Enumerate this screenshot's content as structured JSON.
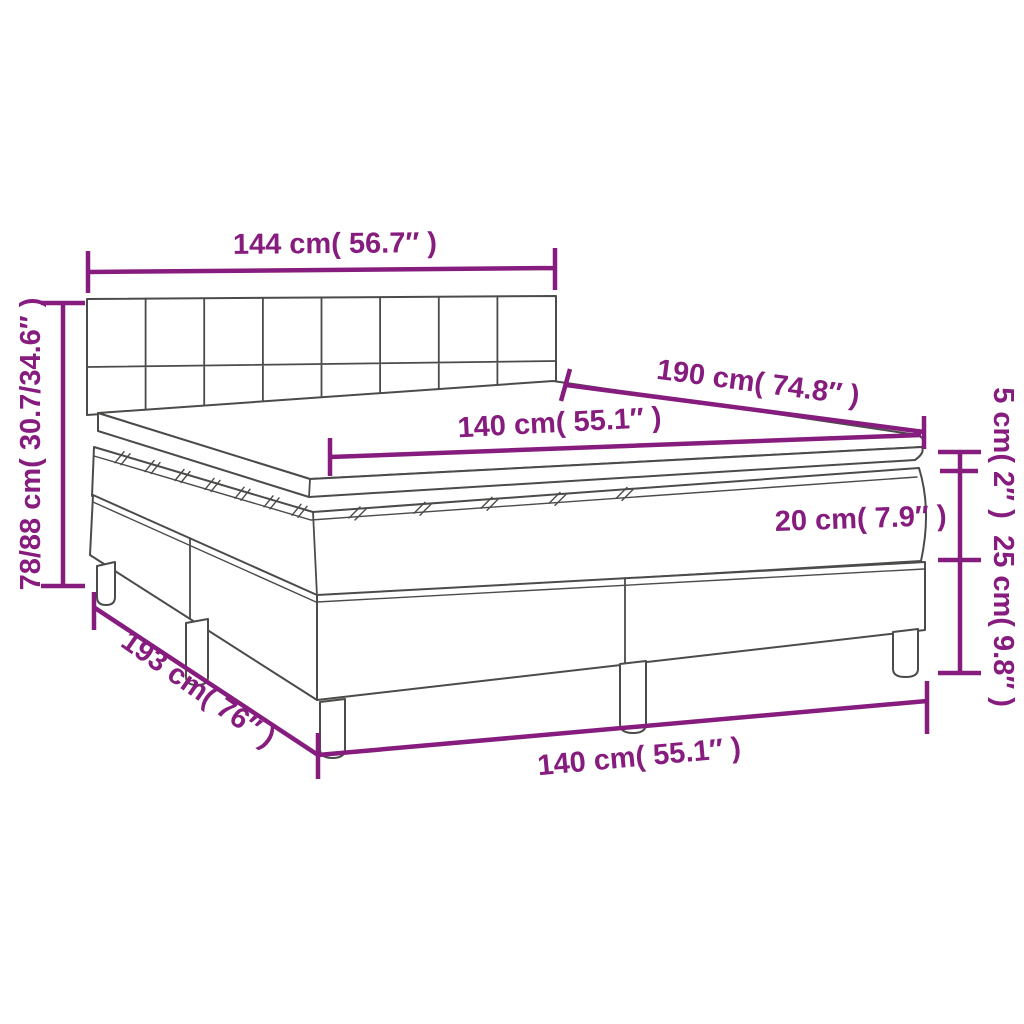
{
  "diagram": {
    "type": "product-dimension-diagram",
    "subject": "box spring bed with headboard, mattress and topper",
    "colors": {
      "dimension_accent": "#871c7f",
      "line_art": "#4b4b49",
      "background": "#ffffff"
    },
    "labels": {
      "headboard_width": "144 cm( 56.7″ )",
      "total_height": "78/88 cm( 30.7/34.6″ )",
      "bed_length_top": "190 cm( 74.8″ )",
      "mattress_width_top": "140 cm( 55.1″ )",
      "topper_thickness": "5 cm( 2″ )",
      "mattress_thickness": "20 cm( 7.9″ )",
      "base_height": "25 cm( 9.8″ )",
      "base_length": "193 cm( 76″ )",
      "base_width_bottom": "140 cm( 55.1″ )"
    }
  }
}
